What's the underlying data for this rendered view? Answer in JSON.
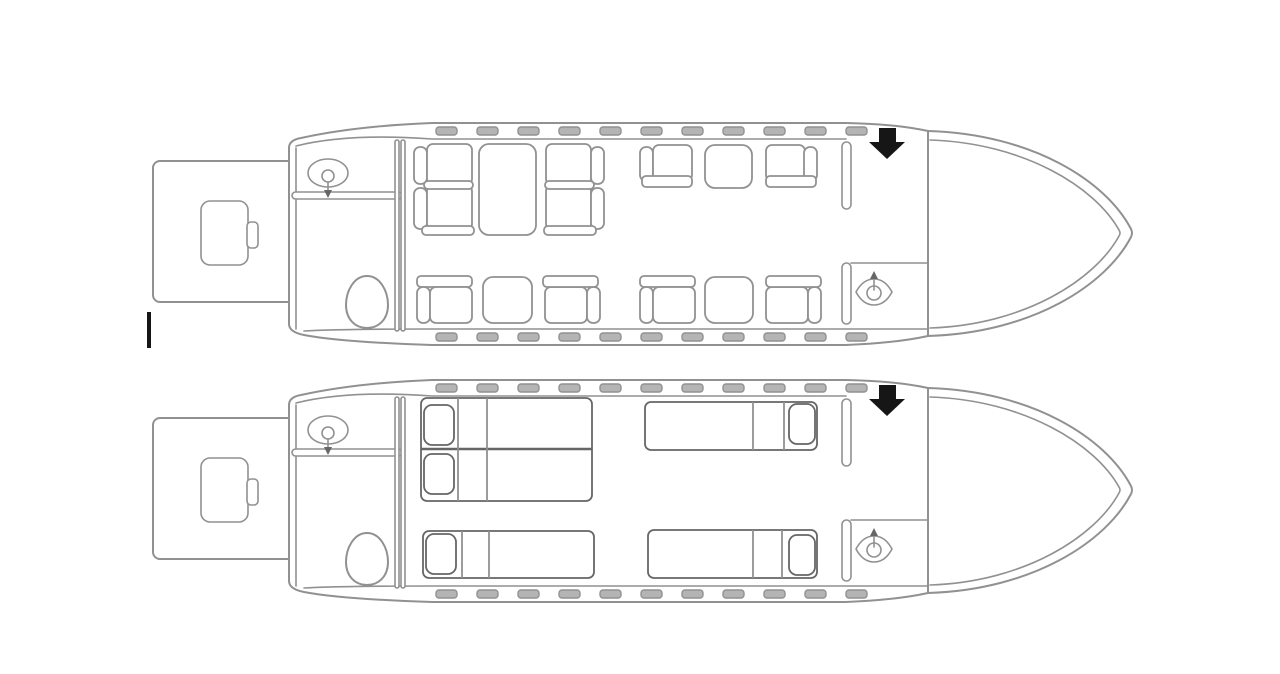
{
  "diagram": {
    "type": "aircraft-cabin-floorplan",
    "description": "Two business-jet cabin layouts, nose right: day seating configuration (top) and night bed configuration (bottom)",
    "colors": {
      "background": "#ffffff",
      "line": "#919191",
      "line_dark": "#666666",
      "window_fill": "#b4b4b4",
      "black": "#161616"
    },
    "summary": {
      "day_seats": 10,
      "day_tables": 4,
      "night_beds": 4,
      "night_pillows": 5,
      "windows_per_side": 11
    }
  },
  "windows": {
    "top_y": 127,
    "bottom_y": 333,
    "w": 21,
    "h": 8,
    "xs": [
      436,
      477,
      518,
      559,
      600,
      641,
      682,
      723,
      764,
      805,
      846
    ]
  },
  "cursor_mark": {
    "x": 147,
    "y": 312,
    "w": 4,
    "h": 36
  },
  "planes": [
    {
      "id": "day",
      "name": "day-configuration",
      "offset_y": 0,
      "furniture": [
        {
          "type": "back",
          "x": 414,
          "y": 147,
          "w": 13,
          "h": 37
        },
        {
          "type": "back",
          "x": 414,
          "y": 188,
          "w": 13,
          "h": 41
        },
        {
          "type": "seat",
          "x": 427,
          "y": 144,
          "w": 45,
          "h": 41
        },
        {
          "type": "seat",
          "x": 427,
          "y": 185,
          "w": 45,
          "h": 45
        },
        {
          "type": "arm",
          "x": 424,
          "y": 181,
          "w": 49,
          "h": 8
        },
        {
          "type": "arm",
          "x": 422,
          "y": 226,
          "w": 52,
          "h": 9
        },
        {
          "type": "table",
          "x": 479,
          "y": 144,
          "w": 57,
          "h": 91
        },
        {
          "type": "seat",
          "x": 546,
          "y": 144,
          "w": 45,
          "h": 41
        },
        {
          "type": "seat",
          "x": 546,
          "y": 185,
          "w": 45,
          "h": 45
        },
        {
          "type": "back",
          "x": 591,
          "y": 147,
          "w": 13,
          "h": 37
        },
        {
          "type": "back",
          "x": 591,
          "y": 188,
          "w": 13,
          "h": 41
        },
        {
          "type": "arm",
          "x": 545,
          "y": 181,
          "w": 49,
          "h": 8
        },
        {
          "type": "arm",
          "x": 544,
          "y": 226,
          "w": 52,
          "h": 9
        },
        {
          "type": "back",
          "x": 640,
          "y": 147,
          "w": 13,
          "h": 34
        },
        {
          "type": "seat",
          "x": 653,
          "y": 145,
          "w": 39,
          "h": 36
        },
        {
          "type": "arm",
          "x": 642,
          "y": 176,
          "w": 50,
          "h": 11
        },
        {
          "type": "table",
          "x": 705,
          "y": 145,
          "w": 47,
          "h": 43
        },
        {
          "type": "seat",
          "x": 766,
          "y": 145,
          "w": 39,
          "h": 36
        },
        {
          "type": "back",
          "x": 804,
          "y": 147,
          "w": 13,
          "h": 34
        },
        {
          "type": "arm",
          "x": 766,
          "y": 176,
          "w": 50,
          "h": 11
        },
        {
          "type": "arm",
          "x": 417,
          "y": 276,
          "w": 55,
          "h": 11
        },
        {
          "type": "back",
          "x": 417,
          "y": 287,
          "w": 13,
          "h": 36
        },
        {
          "type": "seat",
          "x": 430,
          "y": 287,
          "w": 42,
          "h": 36
        },
        {
          "type": "table",
          "x": 483,
          "y": 277,
          "w": 49,
          "h": 46
        },
        {
          "type": "seat",
          "x": 545,
          "y": 287,
          "w": 42,
          "h": 36
        },
        {
          "type": "back",
          "x": 587,
          "y": 287,
          "w": 13,
          "h": 36
        },
        {
          "type": "arm",
          "x": 543,
          "y": 276,
          "w": 55,
          "h": 11
        },
        {
          "type": "arm",
          "x": 640,
          "y": 276,
          "w": 55,
          "h": 11
        },
        {
          "type": "back",
          "x": 640,
          "y": 287,
          "w": 13,
          "h": 36
        },
        {
          "type": "seat",
          "x": 653,
          "y": 287,
          "w": 42,
          "h": 36
        },
        {
          "type": "table",
          "x": 705,
          "y": 277,
          "w": 48,
          "h": 46
        },
        {
          "type": "seat",
          "x": 766,
          "y": 287,
          "w": 42,
          "h": 36
        },
        {
          "type": "back",
          "x": 808,
          "y": 287,
          "w": 13,
          "h": 36
        },
        {
          "type": "arm",
          "x": 766,
          "y": 276,
          "w": 55,
          "h": 11
        }
      ]
    },
    {
      "id": "night",
      "name": "night-configuration",
      "offset_y": 257,
      "furniture": [
        {
          "type": "bed",
          "x": 421,
          "y": 141,
          "w": 171,
          "h": 103
        },
        {
          "type": "hline",
          "x": 421,
          "y": 192,
          "w": 171
        },
        {
          "type": "vline",
          "x": 458,
          "y": 141,
          "h": 103
        },
        {
          "type": "vline",
          "x": 487,
          "y": 141,
          "h": 103
        },
        {
          "type": "pillow",
          "x": 424,
          "y": 148,
          "w": 30,
          "h": 40
        },
        {
          "type": "pillow",
          "x": 424,
          "y": 197,
          "w": 30,
          "h": 40
        },
        {
          "type": "bed",
          "x": 645,
          "y": 145,
          "w": 172,
          "h": 48
        },
        {
          "type": "vline",
          "x": 753,
          "y": 145,
          "h": 48
        },
        {
          "type": "vline",
          "x": 784,
          "y": 145,
          "h": 48
        },
        {
          "type": "pillow",
          "x": 789,
          "y": 147,
          "w": 26,
          "h": 40
        },
        {
          "type": "bed",
          "x": 423,
          "y": 274,
          "w": 171,
          "h": 47
        },
        {
          "type": "vline",
          "x": 462,
          "y": 274,
          "h": 47
        },
        {
          "type": "vline",
          "x": 489,
          "y": 274,
          "h": 47
        },
        {
          "type": "pillow",
          "x": 426,
          "y": 277,
          "w": 30,
          "h": 40
        },
        {
          "type": "bed",
          "x": 648,
          "y": 273,
          "w": 169,
          "h": 48
        },
        {
          "type": "vline",
          "x": 753,
          "y": 273,
          "h": 48
        },
        {
          "type": "vline",
          "x": 782,
          "y": 273,
          "h": 48
        },
        {
          "type": "pillow",
          "x": 789,
          "y": 278,
          "w": 26,
          "h": 40
        }
      ]
    }
  ]
}
